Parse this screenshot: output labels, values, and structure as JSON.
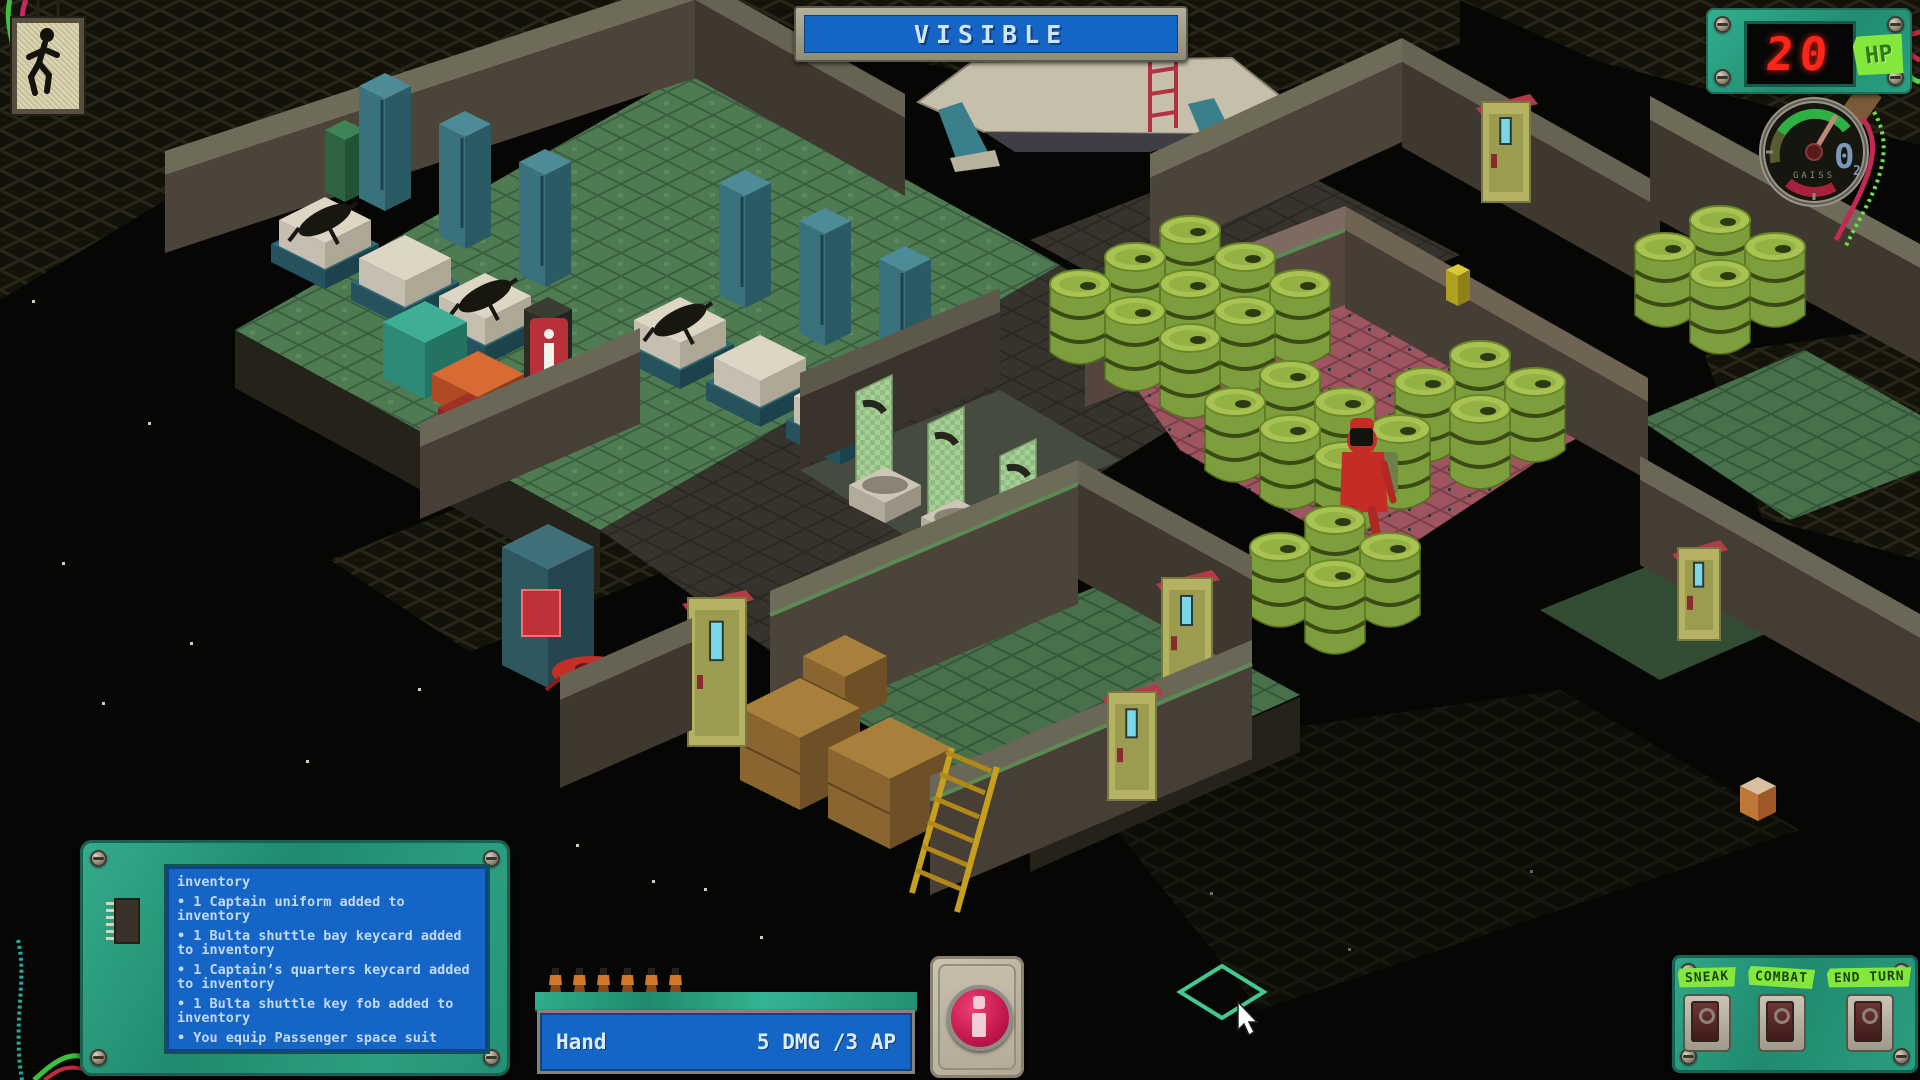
{
  "hud": {
    "exit_sign": {
      "icon": "exit-running-man"
    },
    "visibility_banner": {
      "label": "VISIBLE"
    },
    "hp_display": {
      "value": "20",
      "unit": "HP"
    },
    "oxygen_gauge": {
      "label": "GAISS",
      "value": "0",
      "value_subscript": "2"
    },
    "message_log": {
      "lines": [
        {
          "text": "inventory",
          "strong": false
        },
        {
          "text": "• 1 Captain uniform added to inventory",
          "strong": false
        },
        {
          "text": "• 1 Bulta shuttle bay keycard added to inventory",
          "strong": false
        },
        {
          "text": "• 1 Captain’s quarters keycard added to inventory",
          "strong": false
        },
        {
          "text": "• 1 Bulta shuttle key fob added to inventory",
          "strong": false
        },
        {
          "text": "• You equip Passenger space suit",
          "strong": false
        },
        {
          "text": "• Data loaded...",
          "strong": true
        }
      ]
    },
    "weapon_bar": {
      "weapon_name": "Hand",
      "stats": "5 DMG /3 AP",
      "ap_pips": 6
    },
    "info_button": {
      "glyph": "i"
    },
    "action_panel": {
      "buttons": [
        {
          "label": "SNEAK"
        },
        {
          "label": "COMBAT"
        },
        {
          "label": "END TURN"
        }
      ]
    }
  },
  "colors": {
    "banner_blue": "#1565c6",
    "hud_teal": "#2aa183",
    "hp_red": "#ff2518",
    "tape_green": "#84e83c",
    "tile_cursor": "#41c98f"
  }
}
